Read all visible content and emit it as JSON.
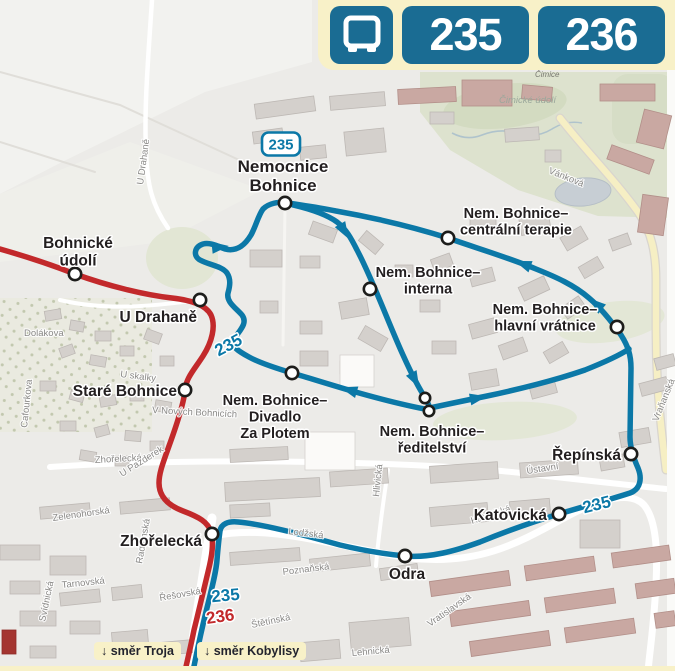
{
  "header": {
    "badges": [
      "235",
      "236"
    ],
    "bus_icon": "bus-icon",
    "bg": "#F8F1C8",
    "badge_color": "#1A6C93"
  },
  "colors": {
    "route_235": "#0B78A7",
    "route_236": "#C2292B",
    "map_bg": "#ECEBE8",
    "stop_label": "#231F20",
    "street_label": "#8A8987",
    "cream": "#F8F1C8",
    "green": "#DDE2CE",
    "water": "#C7CED4"
  },
  "map": {
    "stop_badge": {
      "text": "235",
      "x": 281,
      "y": 144
    },
    "stops": [
      {
        "name": "Nemocnice Bohnice",
        "line": "235",
        "x": 285,
        "y": 203,
        "label": {
          "lines": [
            "Nemocnice",
            "Bohnice"
          ],
          "x": 283,
          "y": 172,
          "anchor": "middle",
          "size": 17
        }
      },
      {
        "name": "Bohnické údolí",
        "line": "236",
        "x": 75,
        "y": 274,
        "label": {
          "lines": [
            "Bohnické",
            "údolí"
          ],
          "x": 78,
          "y": 248,
          "anchor": "middle",
          "size": 15.5
        }
      },
      {
        "name": "U Drahaně",
        "line": "236",
        "x": 200,
        "y": 300,
        "label": {
          "lines": [
            "U Drahaně"
          ],
          "x": 197,
          "y": 322,
          "anchor": "end",
          "size": 15.5
        }
      },
      {
        "name": "Staré Bohnice",
        "line": "236",
        "x": 185,
        "y": 390,
        "label": {
          "lines": [
            "Staré Bohnice"
          ],
          "x": 177,
          "y": 396,
          "anchor": "end",
          "size": 15.5
        }
      },
      {
        "name": "Nem. Bohnice–centrální terapie",
        "line": "235",
        "x": 448,
        "y": 238,
        "label": {
          "lines": [
            "Nem. Bohnice–",
            "centrální terapie"
          ],
          "x": 516,
          "y": 218,
          "anchor": "middle",
          "size": 14.5
        }
      },
      {
        "name": "Nem. Bohnice–interna",
        "line": "235",
        "x": 370,
        "y": 289,
        "label": {
          "lines": [
            "Nem. Bohnice–",
            "interna"
          ],
          "x": 428,
          "y": 277,
          "anchor": "middle",
          "size": 14.5
        }
      },
      {
        "name": "Nem. Bohnice–hlavní vrátnice",
        "line": "235",
        "x": 617,
        "y": 327,
        "label": {
          "lines": [
            "Nem. Bohnice–",
            "hlavní vrátnice"
          ],
          "x": 545,
          "y": 314,
          "anchor": "middle",
          "size": 14.5
        }
      },
      {
        "name": "Nem. Bohnice–Divadlo Za Plotem",
        "line": "235",
        "x": 292,
        "y": 373,
        "label": {
          "lines": [
            "Nem. Bohnice–",
            "Divadlo",
            "Za Plotem"
          ],
          "x": 275,
          "y": 405,
          "anchor": "middle",
          "size": 14.5
        }
      },
      {
        "name": "Nem. Bohnice–ředitelství",
        "line": "235",
        "dots": [
          [
            425,
            398
          ],
          [
            429,
            411
          ]
        ],
        "label": {
          "lines": [
            "Nem. Bohnice–",
            "ředitelství"
          ],
          "x": 432,
          "y": 436,
          "anchor": "middle",
          "size": 14.5
        }
      },
      {
        "name": "Řepínská",
        "line": "235",
        "x": 631,
        "y": 454,
        "label": {
          "lines": [
            "Řepínská"
          ],
          "x": 621,
          "y": 460,
          "anchor": "end",
          "size": 15.5
        }
      },
      {
        "name": "Katovická",
        "line": "235",
        "x": 559,
        "y": 514,
        "label": {
          "lines": [
            "Katovická"
          ],
          "x": 547,
          "y": 520,
          "anchor": "end",
          "size": 15.5
        }
      },
      {
        "name": "Odra",
        "line": "235",
        "x": 405,
        "y": 556,
        "label": {
          "lines": [
            "Odra"
          ],
          "x": 407,
          "y": 579,
          "anchor": "middle",
          "size": 15.5
        }
      },
      {
        "name": "Zhořelecká",
        "line": "both",
        "x": 212,
        "y": 534,
        "label": {
          "lines": [
            "Zhořelecká"
          ],
          "x": 202,
          "y": 546,
          "anchor": "end",
          "size": 15.5
        }
      }
    ],
    "inline_route_labels": [
      {
        "text": "235",
        "x": 231,
        "y": 350,
        "rot": -28,
        "line": "235"
      },
      {
        "text": "235",
        "x": 598,
        "y": 510,
        "rot": -14,
        "line": "235"
      },
      {
        "text": "235",
        "x": 226,
        "y": 601,
        "rot": -5,
        "line": "235"
      },
      {
        "text": "236",
        "x": 221,
        "y": 622,
        "rot": -8,
        "line": "236"
      }
    ],
    "street_labels": [
      {
        "text": "U Drahaně",
        "x": 143,
        "y": 185,
        "rot": -82
      },
      {
        "text": "Dolákova",
        "x": 24,
        "y": 336,
        "rot": 0
      },
      {
        "text": "Cafourkova",
        "x": 27,
        "y": 428,
        "rot": -84
      },
      {
        "text": "U skalky",
        "x": 120,
        "y": 377,
        "rot": 7
      },
      {
        "text": "V Nových Bohnicích",
        "x": 152,
        "y": 413,
        "rot": 3
      },
      {
        "text": "Zhořelecká",
        "x": 95,
        "y": 463,
        "rot": -3
      },
      {
        "text": "U Pazderek",
        "x": 122,
        "y": 477,
        "rot": -32
      },
      {
        "text": "Zelenohorská",
        "x": 53,
        "y": 521,
        "rot": -8
      },
      {
        "text": "Tarnovská",
        "x": 62,
        "y": 588,
        "rot": -6
      },
      {
        "text": "Svídnická",
        "x": 45,
        "y": 622,
        "rot": -78
      },
      {
        "text": "Radomská",
        "x": 142,
        "y": 564,
        "rot": -80
      },
      {
        "text": "Řešovská",
        "x": 160,
        "y": 601,
        "rot": -10
      },
      {
        "text": "Štětínská",
        "x": 252,
        "y": 628,
        "rot": -12
      },
      {
        "text": "Lehnická",
        "x": 352,
        "y": 656,
        "rot": -5
      },
      {
        "text": "Vratislavská",
        "x": 430,
        "y": 627,
        "rot": -35
      },
      {
        "text": "Poznaňská",
        "x": 283,
        "y": 575,
        "rot": -7
      },
      {
        "text": "Lodžská",
        "x": 288,
        "y": 534,
        "rot": 7
      },
      {
        "text": "Hlivická",
        "x": 379,
        "y": 497,
        "rot": -84
      },
      {
        "text": "Ústavní",
        "x": 527,
        "y": 474,
        "rot": -9
      },
      {
        "text": "Katovická",
        "x": 472,
        "y": 524,
        "rot": -18
      },
      {
        "text": "Vraňanská",
        "x": 658,
        "y": 422,
        "rot": -68
      },
      {
        "text": "Vánková",
        "x": 548,
        "y": 173,
        "rot": 22
      }
    ],
    "area_labels": [
      {
        "text": "Čimice",
        "x": 535,
        "y": 77,
        "size": 8,
        "color": "#77776F"
      },
      {
        "text": "Čimické údolí",
        "x": 499,
        "y": 103,
        "size": 9.5,
        "color": "#9AA79B"
      }
    ],
    "direction_labels": [
      {
        "arrow": "↓",
        "text": "směr Troja",
        "left": 94,
        "top": 642
      },
      {
        "arrow": "↓",
        "text": "směr Kobylisy",
        "left": 197,
        "top": 642
      }
    ]
  }
}
